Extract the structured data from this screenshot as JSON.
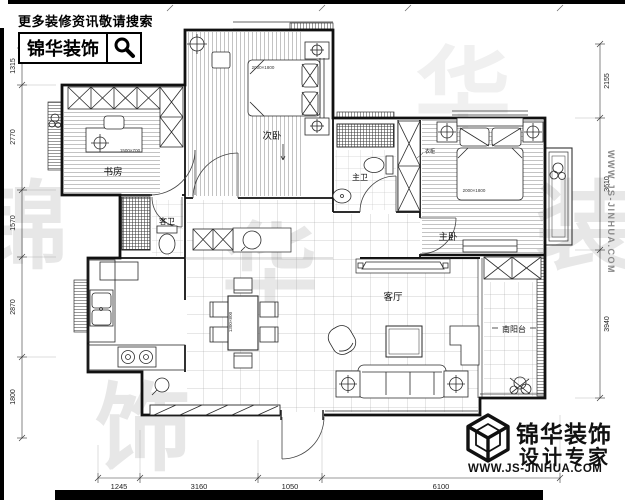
{
  "header": {
    "tagline": "更多装修资讯敬请搜索",
    "brand": "锦华装饰"
  },
  "rooms": {
    "study": "书房",
    "second_bedroom": "次卧",
    "master_bath": "主卫",
    "master_bedroom": "主卧",
    "guest_bath": "客卫",
    "living_room": "客厅",
    "south_balcony": "南阳台",
    "wardrobe": "衣柜"
  },
  "furniture": {
    "master_bed_size": "2000×1800",
    "second_bed_size": "2000×1800",
    "desk_size": "1500×700",
    "dining_table_size": "1300×800"
  },
  "dimensions": {
    "left": [
      "1315",
      "2770",
      "1570",
      "2870",
      "1800"
    ],
    "right": [
      "2155",
      "3610",
      "3940"
    ],
    "bottom": [
      "1245",
      "3160",
      "1050",
      "6100"
    ]
  },
  "watermark": {
    "chars": [
      "锦",
      "华",
      "装",
      "饰"
    ],
    "site_vertical": "WWW.JS-JINHUA.COM"
  },
  "footer": {
    "brand_line1": "锦华装饰",
    "brand_line2": "设计专家",
    "site": "WWW.JS-JINHUA.COM"
  },
  "colors": {
    "line": "#1a1a1a",
    "watermark": "#e7e7e7"
  }
}
